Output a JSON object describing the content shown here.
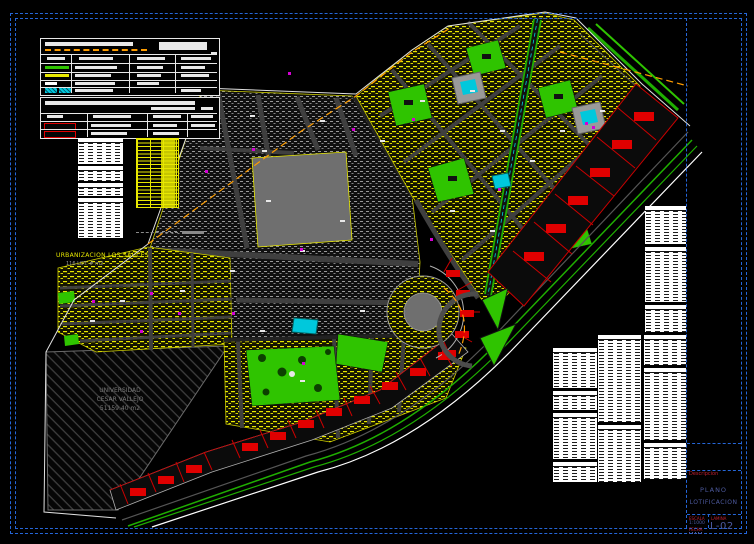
{
  "sheet": {
    "frame_color": "#2566d8",
    "background": "#000000"
  },
  "map": {
    "urbanization_label": "URBANIZACION LOS SAUCES",
    "urbanization_sublabel": "116 LOT. # m2",
    "reserve_area": {
      "line1": "UNIVERSIDAD",
      "line2": "CESAR VALLEJO",
      "line3": "51159.40 m2"
    },
    "colors": {
      "residential_lots": "#e8e800",
      "parks": "#2fc400",
      "commercial_buildings": "#e00000",
      "pools": "#00c8dc",
      "roads": "#3f3f3f",
      "boundary_line": "#ff9d00",
      "existing_blocks": "#9a9a9a"
    }
  },
  "legend_symbols": {
    "panel1": [
      "orange-dashed-line",
      "green-line",
      "yellow-line",
      "white-line",
      "cyan-hatch"
    ],
    "panel2": [
      "red-outline-lot",
      "red-outline-lot"
    ]
  },
  "title_block": {
    "descripcion_label": "Descripcion",
    "plano_line1": "PLANO",
    "plano_line2": "LOTIFICACION",
    "escala_label": "ESCALA",
    "escala_value": "1:1000",
    "fecha_label": "FECHA",
    "lamina_label": "LAMINA",
    "sheet_number": "L-02"
  }
}
